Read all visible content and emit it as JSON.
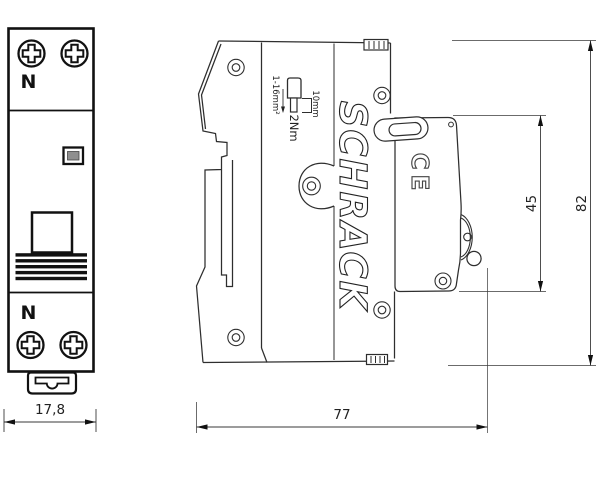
{
  "front_view": {
    "terminal_label_top": "N",
    "terminal_label_bottom": "N",
    "width_dim": "17,8"
  },
  "side_view": {
    "brand": "SCHRACK",
    "ce_mark": "CE",
    "wire_range": "1-16mm²",
    "strip_length": "10mm",
    "torque": "2Nm",
    "dim_front_height": "45",
    "dim_total_height": "82",
    "dim_depth": "77"
  },
  "colors": {
    "line": "#1a1a1a",
    "thin_line": "#2e2e2e",
    "dimension_line": "#3a3a3a",
    "indicator_fill": "#8f8f8f",
    "background": "#ffffff"
  }
}
